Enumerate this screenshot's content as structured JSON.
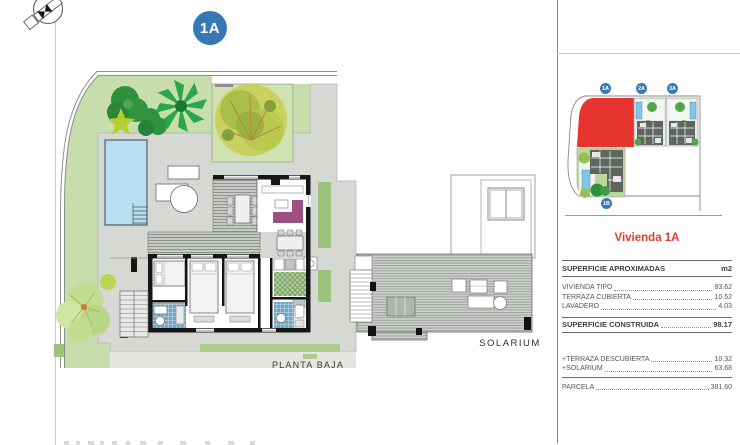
{
  "page": {
    "badge": "1A",
    "plan_label": "PLANTA BAJA",
    "solarium_label": "SOLARIUM"
  },
  "site_plan": {
    "units": [
      "1A",
      "2A",
      "3A",
      "1B"
    ]
  },
  "panel": {
    "title": "Vivienda 1A",
    "table": {
      "header": {
        "label": "SUPERFICIE APROXIMADAS",
        "unit": "m2"
      },
      "rows": [
        {
          "label": "VIVIENDA TIPO",
          "value": "83.62"
        },
        {
          "label": "TERRAZA CUBIERTA",
          "value": "10.52"
        },
        {
          "label": "LAVADERO",
          "value": "4.03"
        }
      ],
      "total": {
        "label": "SUPERFICIE CONSTRUIDA",
        "value": "98.17"
      },
      "extras": [
        {
          "label": "+TERRAZA DESCUBIERTA",
          "value": "10.32"
        },
        {
          "label": "+SOLARIUM",
          "value": "63.68"
        }
      ],
      "parcel": {
        "label": "PARCELA",
        "value": "381.60"
      }
    }
  },
  "colors": {
    "accent_red": "#e6342e",
    "title_red": "#e23b2f",
    "badge_blue": "#3878b4",
    "pool_blue": "#b8def0",
    "garden_green": "#c8ddac",
    "paving_gray": "#d6d8d3",
    "wall_black": "#161616",
    "sofa_plum": "#9c5280",
    "divider_red_line": "#c96a6a"
  }
}
